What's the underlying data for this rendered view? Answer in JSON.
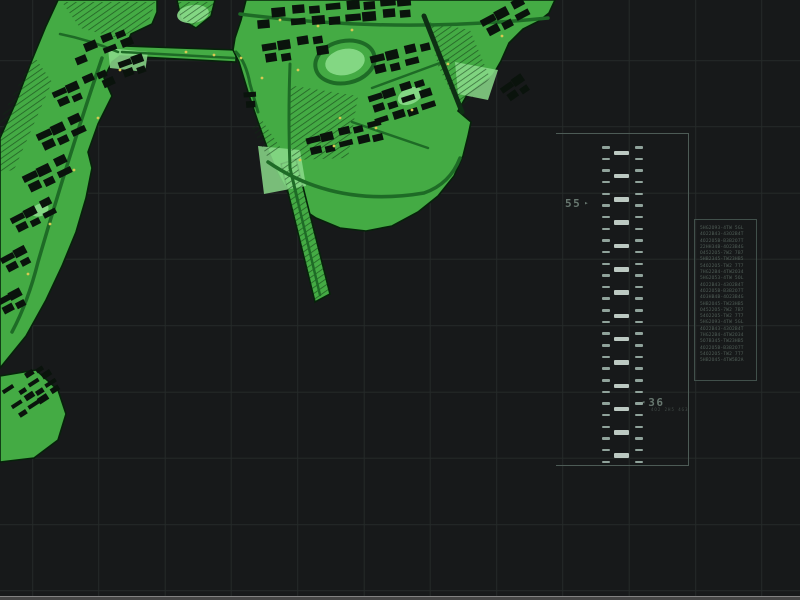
{
  "hud": {
    "grid": {
      "spacing": 66.3,
      "offset_x": 33,
      "offset_y": 61,
      "color": "#252a29"
    },
    "ladder": {
      "border_color": "#4d5b56",
      "tick_color": "#90a39b",
      "bar_color": "#bcc9c2",
      "marker_color": "#67776f",
      "left_ticks": {
        "x": 602,
        "w": 8,
        "h": 2.5,
        "start_y": 145,
        "step": 11.65,
        "count": 28
      },
      "right_ticks": {
        "x": 635,
        "w": 8,
        "h": 2.5,
        "start_y": 145,
        "step": 11.65,
        "count": 28
      },
      "bars": {
        "x": 614,
        "w": 15,
        "h": 4.5,
        "start_y": 149.5,
        "step": 23.3,
        "count": 14
      },
      "marker_left": {
        "label": "55",
        "arrow": "▸",
        "x": 565,
        "y": 197
      },
      "marker_right": {
        "label": "36",
        "arrow": "◂",
        "x": 641,
        "y": 396,
        "sub": "4O2 2H5 4G3"
      }
    },
    "info_panel": {
      "border_color": "#41504b",
      "text_color": "#5c6c64",
      "lines": [
        "5HG2O93-4TW 5GL",
        "4O22B43-43O2B4T",
        "4O22O5B-B3B2O7T",
        "22HH34B-4O23B4G",
        "O4522O5-7W2 7B7",
        "5HB2345-TW23HB5",
        "54O22O5-TW2 7T7",
        "7HG22B4-4TW2O34",
        "5HG2O53-4TW 5OL",
        "4O22B43-43O2B4T",
        "4O22O5B-B3B2O7T",
        "4O3HB4B-4O23B4G",
        "5HB2O45-TW23HB5",
        "O4522O5-7W2 7B7",
        "54O22O5-TW2 7T7",
        "5HG2O93-4TW 5GL",
        "4O22B43-43O2B4T",
        "7HG22B4-4TW2O34",
        "5O7B345-TW23HB5",
        "4O22O5B-B3B2O7T",
        "54O22O5-TW2 7T7",
        "5HB2O45-4TW5B2A"
      ]
    },
    "bottom_bar": {
      "edge_color": "#828282",
      "body_color": "#454545"
    }
  },
  "map": {
    "colors": {
      "land": "#44ab44",
      "land_light": "#8bdb8b",
      "outline": "#06230a",
      "road": "#1e6b26",
      "channel": "#0e2f14",
      "building": "#0a130c",
      "hatch": "#0c2e10",
      "dot": "#d8c852"
    },
    "land": [
      {
        "name": "west-peninsula",
        "d": "M58,0 L46,26 L32,60 L16,102 L0,138 L0,368 L26,336 L46,300 L62,266 L76,232 L86,198 L92,168 L88,152 L98,124 L112,96 L104,78 L112,62 L120,56 L236,62 L236,50 L126,46 L131,34 L152,24 L157,12 L157,0 Z"
      },
      {
        "name": "north-grove-islet",
        "d": "M177,0 L215,0 L211,16 L196,28 L181,19 Z"
      },
      {
        "name": "east-district",
        "d": "M246,0 L241,20 L235,38 L233,50 L239,62 L248,92 L258,122 L268,150 L278,174 L290,196 L298,206 L316,218 L340,228 L366,231 L392,226 L418,212 L438,196 L454,176 L463,156 L468,136 L471,122 L458,111 L467,95 L480,85 L493,75 L501,61 L509,43 L523,29 L539,21 L549,13 L555,0 Z"
      },
      {
        "name": "pier",
        "d": "M281,164 L296,159 L330,294 L315,302 Z"
      },
      {
        "name": "southwest-docks",
        "d": "M0,376 L36,370 L58,390 L66,414 L58,440 L34,458 L0,462 Z"
      }
    ],
    "hatch_areas": [
      "M288,85 L358,96 L348,158 L292,160 Z",
      "M428,22 L470,30 L490,78 L460,110 L438,66 Z",
      "M34,56 L52,82 L14,170 L0,172 L0,120 Z",
      "M177,2 L214,2 L210,18 L194,27 L180,16 Z",
      "M62,2 L155,2 L148,24 L118,38 L80,28 Z",
      "M281,164 L296,159 L330,294 L315,302 Z",
      "M262,120 L282,150 L268,158 L252,128 Z"
    ],
    "patches": [
      {
        "type": "ellipse",
        "cx": 345,
        "cy": 62,
        "rx": 20,
        "ry": 13,
        "rot": -12
      },
      {
        "type": "path",
        "d": "M258,146 L300,150 L306,186 L264,194 Z"
      },
      {
        "type": "ellipse",
        "cx": 193,
        "cy": 14,
        "rx": 16,
        "ry": 9,
        "rot": -8
      },
      {
        "type": "ellipse",
        "cx": 410,
        "cy": 96,
        "rx": 13,
        "ry": 8,
        "rot": -25
      },
      {
        "type": "path",
        "d": "M108,48 L148,52 L145,72 L110,68 Z"
      },
      {
        "type": "path",
        "d": "M455,62 L498,70 L488,100 L458,94 Z"
      },
      {
        "type": "ellipse",
        "cx": 40,
        "cy": 210,
        "rx": 9,
        "ry": 6,
        "rot": -25
      }
    ],
    "rings": [
      {
        "cx": 345,
        "cy": 62,
        "rx": 30,
        "ry": 21,
        "rot": -12,
        "w": 4
      }
    ],
    "roads": [
      {
        "d": "M240,14 Q390,34 548,18",
        "w": 3.5
      },
      {
        "d": "M236,52 Q246,62 250,84 L258,112",
        "w": 3
      },
      {
        "d": "M290,64 Q288,120 290,168 L298,202",
        "w": 3
      },
      {
        "d": "M298,202 L320,295",
        "w": 2.5
      },
      {
        "d": "M268,162 Q335,208 424,193 Q450,184 460,158",
        "w": 3.5
      },
      {
        "d": "M372,88 L448,60",
        "w": 2.5
      },
      {
        "d": "M352,122 L428,148",
        "w": 2.5
      },
      {
        "d": "M102,58 Q70,152 38,262 Q28,302 12,332",
        "w": 3.5
      },
      {
        "d": "M122,52 L234,58",
        "w": 2.5
      },
      {
        "d": "M60,34 Q90,40 118,52",
        "w": 2.5
      },
      {
        "d": "M424,16 L462,112",
        "w": 5,
        "dark": true
      }
    ],
    "building_clusters": [
      {
        "x": 70,
        "y": 50,
        "rot": -22,
        "rows": 2,
        "cols": 4,
        "bw": 12,
        "bh": 7,
        "gx": 16,
        "gy": 11
      },
      {
        "x": 52,
        "y": 92,
        "rot": -24,
        "rows": 2,
        "cols": 4,
        "bw": 12,
        "bh": 7,
        "gx": 16,
        "gy": 11
      },
      {
        "x": 36,
        "y": 134,
        "rot": -25,
        "rows": 2,
        "cols": 3,
        "bw": 13,
        "bh": 8,
        "gx": 17,
        "gy": 12
      },
      {
        "x": 22,
        "y": 176,
        "rot": -26,
        "rows": 2,
        "cols": 3,
        "bw": 13,
        "bh": 8,
        "gx": 17,
        "gy": 12
      },
      {
        "x": 10,
        "y": 218,
        "rot": -27,
        "rows": 2,
        "cols": 3,
        "bw": 12,
        "bh": 7,
        "gx": 16,
        "gy": 11
      },
      {
        "x": 0,
        "y": 258,
        "rot": -28,
        "rows": 2,
        "cols": 2,
        "bw": 12,
        "bh": 7,
        "gx": 16,
        "gy": 11
      },
      {
        "x": -4,
        "y": 300,
        "rot": -28,
        "rows": 2,
        "cols": 2,
        "bw": 12,
        "bh": 7,
        "gx": 15,
        "gy": 11
      },
      {
        "x": 118,
        "y": 62,
        "rot": -20,
        "rows": 2,
        "cols": 2,
        "bw": 11,
        "bh": 7,
        "gx": 15,
        "gy": 11
      },
      {
        "x": 2,
        "y": 390,
        "rot": -33,
        "rows": 4,
        "cols": 4,
        "bw": 10,
        "bh": 5,
        "gx": 13,
        "gy": 9
      },
      {
        "x": 255,
        "y": 10,
        "rot": -5,
        "rows": 2,
        "cols": 9,
        "bw": 13,
        "bh": 8,
        "gx": 18,
        "gy": 12
      },
      {
        "x": 262,
        "y": 44,
        "rot": -9,
        "rows": 2,
        "cols": 4,
        "bw": 12,
        "bh": 8,
        "gx": 17,
        "gy": 12
      },
      {
        "x": 370,
        "y": 56,
        "rot": -14,
        "rows": 2,
        "cols": 4,
        "bw": 12,
        "bh": 8,
        "gx": 17,
        "gy": 12
      },
      {
        "x": 368,
        "y": 96,
        "rot": -18,
        "rows": 3,
        "cols": 4,
        "bw": 12,
        "bh": 7,
        "gx": 16,
        "gy": 12
      },
      {
        "x": 306,
        "y": 138,
        "rot": -14,
        "rows": 2,
        "cols": 5,
        "bw": 12,
        "bh": 7,
        "gx": 16,
        "gy": 12
      },
      {
        "x": 480,
        "y": 20,
        "rot": -28,
        "rows": 2,
        "cols": 3,
        "bw": 13,
        "bh": 8,
        "gx": 17,
        "gy": 12
      },
      {
        "x": 500,
        "y": 88,
        "rot": -35,
        "rows": 2,
        "cols": 2,
        "bw": 11,
        "bh": 7,
        "gx": 15,
        "gy": 11
      },
      {
        "x": 244,
        "y": 92,
        "rot": -4,
        "rows": 3,
        "cols": 1,
        "bw": 10,
        "bh": 6,
        "gx": 14,
        "gy": 11
      }
    ],
    "dots": [
      [
        186,
        52
      ],
      [
        214,
        55
      ],
      [
        241,
        58
      ],
      [
        280,
        20
      ],
      [
        318,
        26
      ],
      [
        352,
        30
      ],
      [
        298,
        70
      ],
      [
        262,
        78
      ],
      [
        340,
        118
      ],
      [
        376,
        128
      ],
      [
        412,
        110
      ],
      [
        448,
        64
      ],
      [
        502,
        36
      ],
      [
        120,
        70
      ],
      [
        98,
        118
      ],
      [
        74,
        170
      ],
      [
        50,
        224
      ],
      [
        28,
        274
      ],
      [
        300,
        160
      ],
      [
        334,
        146
      ]
    ]
  }
}
